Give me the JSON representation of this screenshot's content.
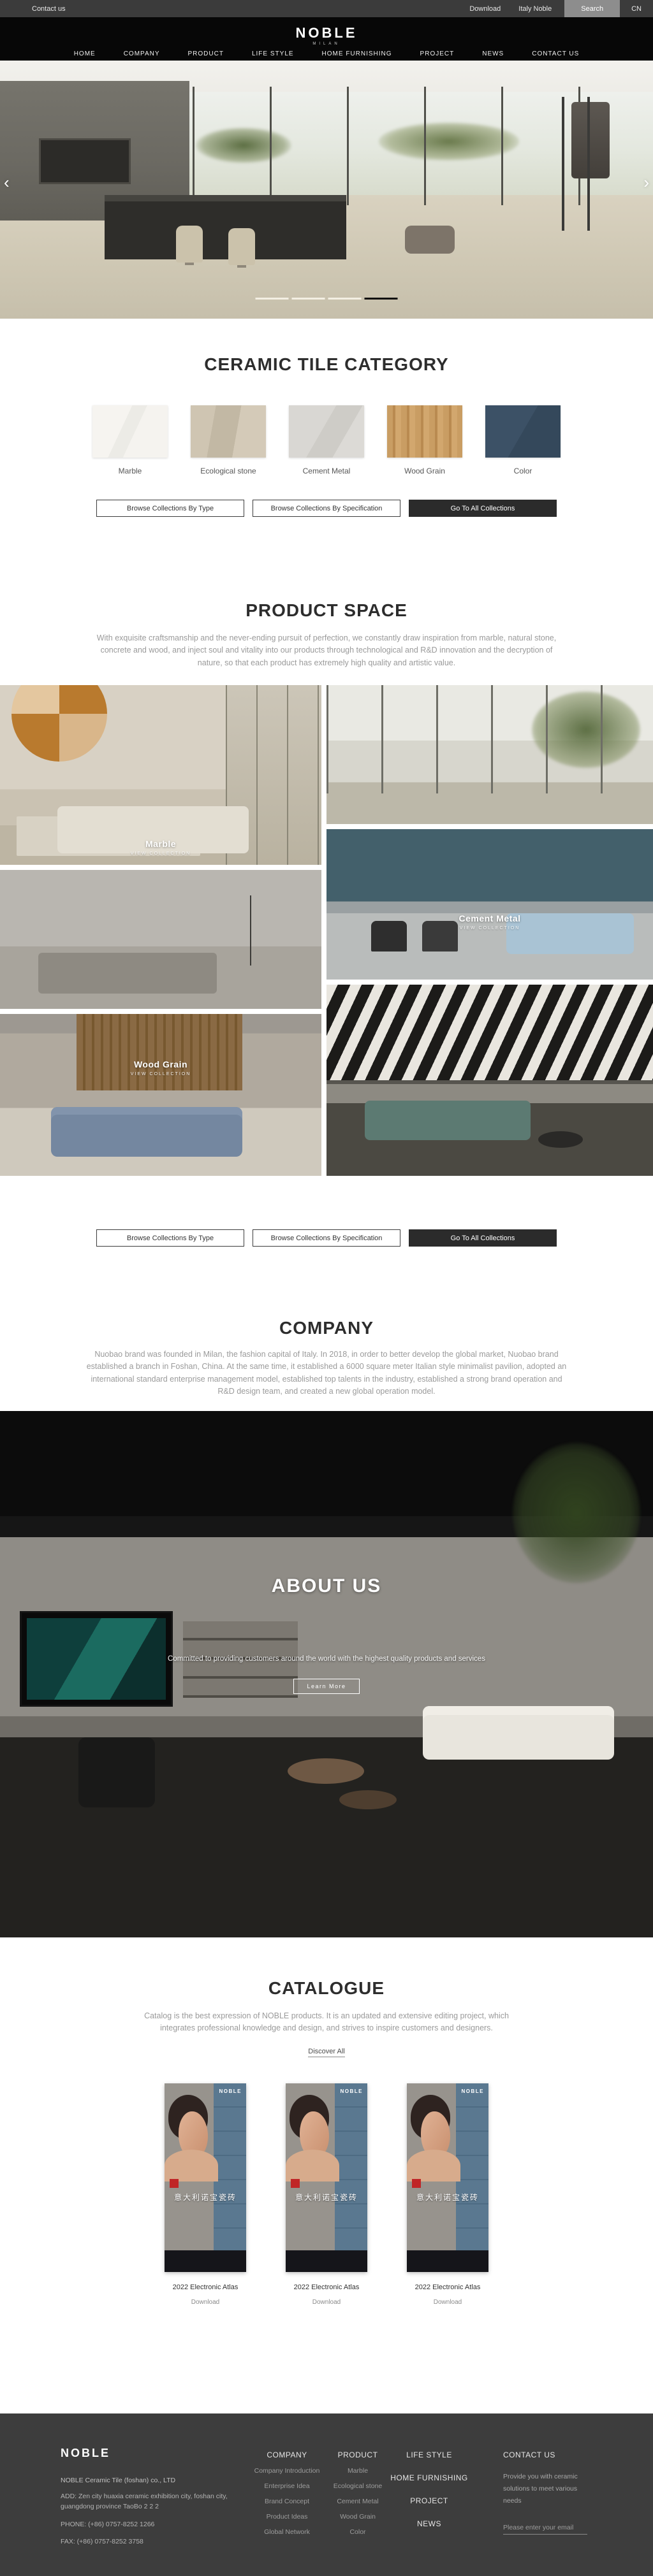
{
  "topbar": {
    "contact": "Contact us",
    "download": "Download",
    "italy": "Italy Noble",
    "search": "Search",
    "lang": "CN"
  },
  "brand": {
    "logo": "NOBLE",
    "sub": "MILAN"
  },
  "nav": {
    "items": [
      "HOME",
      "COMPANY",
      "PRODUCT",
      "LIFE STYLE",
      "HOME FURNISHING",
      "PROJECT",
      "NEWS",
      "CONTACT US"
    ]
  },
  "hero": {
    "prev": "‹",
    "next": "›"
  },
  "category": {
    "title": "CERAMIC TILE CATEGORY",
    "tiles": [
      {
        "label": "Marble"
      },
      {
        "label": "Ecological stone"
      },
      {
        "label": "Cement Metal"
      },
      {
        "label": "Wood Grain"
      },
      {
        "label": "Color"
      }
    ]
  },
  "buttons": {
    "by_type": "Browse Collections By Type",
    "by_spec": "Browse Collections By Specification",
    "all": "Go To All Collections"
  },
  "product_space": {
    "title": "PRODUCT SPACE",
    "description": "With exquisite craftsmanship and the never-ending pursuit of perfection, we constantly draw inspiration from marble, natural stone, concrete and wood, and inject soul and vitality into our products through technological and R&D innovation and the decryption of nature, so that each product has extremely high quality and artistic value."
  },
  "collections": [
    {
      "name": "Marble",
      "cta": "VIEW COLLECTION"
    },
    {
      "name": "Cement Metal",
      "cta": "VIEW COLLECTION"
    },
    {
      "name": "Wood Grain",
      "cta": "VIEW COLLECTION"
    }
  ],
  "company": {
    "title": "COMPANY",
    "description": "Nuobao brand was founded in Milan, the fashion capital of Italy. In 2018, in order to better develop the global market, Nuobao brand established a branch in Foshan, China. At the same time, it established a 6000 square meter Italian style minimalist pavilion, adopted an international standard enterprise management model, established top talents in the industry, established a strong brand operation and R&D design team, and created a new global operation model."
  },
  "about": {
    "title": "ABOUT US",
    "description": "Committed to providing customers around the world with the highest quality products and services",
    "button": "Learn More"
  },
  "catalogue": {
    "title": "CATALOGUE",
    "description": "Catalog is the best expression of NOBLE products. It is an updated and extensive editing project, which integrates professional knowledge and design, and strives to inspire customers and designers.",
    "link": "Discover All",
    "cards": [
      {
        "cover_brand": "NOBLE",
        "cover_title": "意大利诺宝瓷砖",
        "title": "2022 Electronic Atlas",
        "action": "Download"
      },
      {
        "cover_brand": "NOBLE",
        "cover_title": "意大利诺宝瓷砖",
        "title": "2022 Electronic Atlas",
        "action": "Download"
      },
      {
        "cover_brand": "NOBLE",
        "cover_title": "意大利诺宝瓷砖",
        "title": "2022 Electronic Atlas",
        "action": "Download"
      }
    ]
  },
  "footer": {
    "logo": "NOBLE",
    "company_name": "NOBLE Ceramic Tile (foshan) co., LTD",
    "address": "ADD:  Zen city huaxia ceramic exhibition city, foshan city, guangdong province TaoBo 2 2 2",
    "phone": "PHONE:   (+86)  0757-8252 1266",
    "fax": "FAX:   (+86)  0757-8252 3758",
    "col_company": {
      "header": "COMPANY",
      "items": [
        "Company Introduction",
        "Enterprise Idea",
        "Brand Concept",
        "Product Ideas",
        "Global Network"
      ]
    },
    "col_product": {
      "header": "PRODUCT",
      "items": [
        "Marble",
        "Ecological stone",
        "Cement Metal",
        "Wood Grain",
        "Color"
      ]
    },
    "col_links": {
      "items": [
        "LIFE STYLE",
        "HOME FURNISHING",
        "PROJECT",
        "NEWS"
      ]
    },
    "col_contact": {
      "header": "CONTACT US",
      "text": "Provide you with ceramic solutions to meet various needs",
      "email_placeholder": "Please enter your email"
    }
  },
  "colors": {
    "accent_dark": "#2b2b2b",
    "footer_bg": "#3d3d3d",
    "topbar_bg": "#3b3b3b",
    "active_bar": "#101010"
  }
}
